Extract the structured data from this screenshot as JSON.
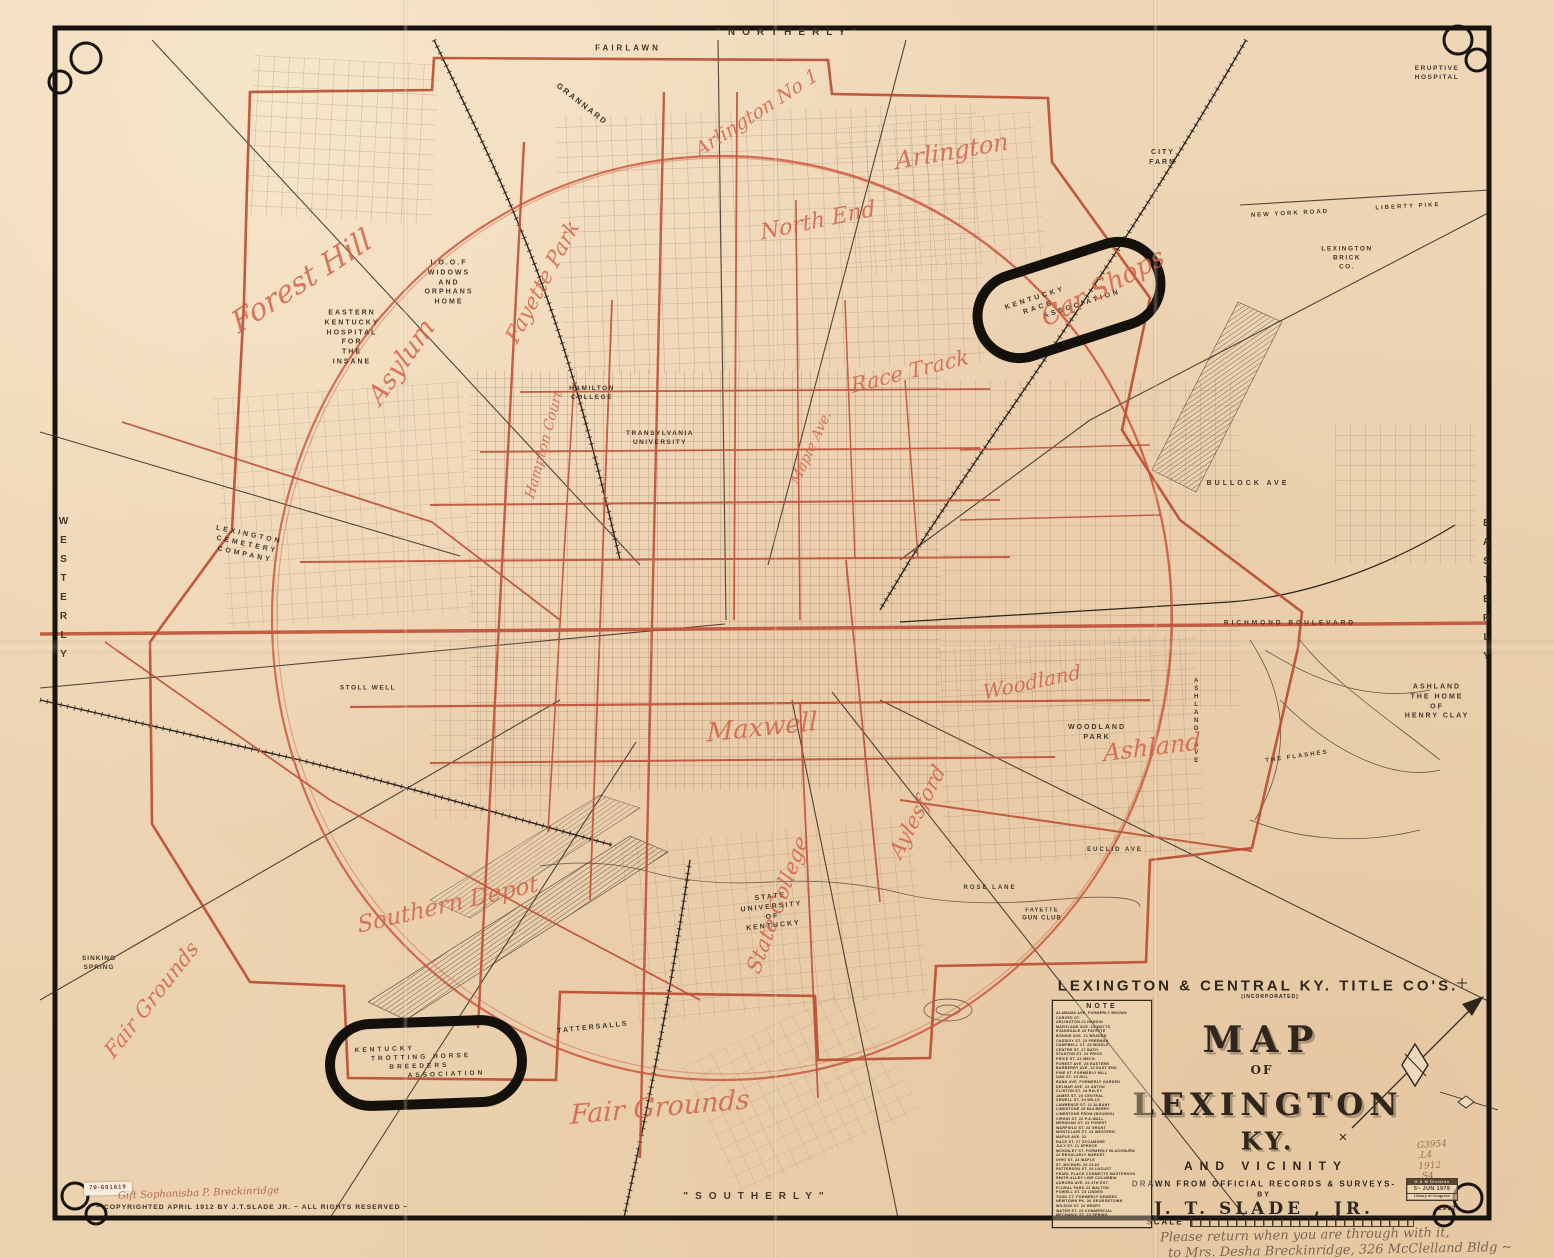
{
  "colors": {
    "paper": "#eed6b6",
    "ink": "#362b20",
    "red_print": "#bf5038",
    "red_script": "#d05f46",
    "frame": "#191310",
    "pencil": "#97714d",
    "graphite": "#6e5d49"
  },
  "map_labels": [
    {
      "n": "northerly",
      "t": "\"NORTHERLY\"",
      "x": 790,
      "y": 33,
      "s": 10,
      "ls": 7,
      "cls": "print"
    },
    {
      "n": "southerly",
      "t": "\"SOUTHERLY\"",
      "x": 757,
      "y": 1197,
      "s": 10,
      "ls": 7,
      "cls": "print"
    },
    {
      "n": "westerly",
      "t": "WESTERLY",
      "x": 63,
      "y": 592,
      "s": 10,
      "ls": 8,
      "cls": "print",
      "vert": true
    },
    {
      "n": "easterly",
      "t": "EASTERLY",
      "x": 1486,
      "y": 594,
      "s": 10,
      "ls": 8,
      "cls": "print",
      "vert": true
    },
    {
      "n": "fairlawn",
      "t": "FAIRLAWN",
      "x": 628,
      "y": 48,
      "s": 8,
      "ls": 3,
      "cls": "print"
    },
    {
      "n": "grannard",
      "t": "GRANNARD",
      "x": 582,
      "y": 104,
      "r": 38,
      "s": 8,
      "ls": 2,
      "cls": "print"
    },
    {
      "n": "city-farm",
      "lines": [
        "CITY",
        "FARM"
      ],
      "x": 1163,
      "y": 158,
      "s": 7,
      "ls": 2,
      "cls": "print"
    },
    {
      "n": "eruptive-hospital",
      "lines": [
        "ERUPTIVE",
        "HOSPITAL"
      ],
      "x": 1437,
      "y": 73,
      "s": 6.5,
      "ls": 1.5,
      "cls": "print"
    },
    {
      "n": "lexington-brick-co",
      "lines": [
        "LEXINGTON",
        "BRICK",
        "CO."
      ],
      "x": 1347,
      "y": 258,
      "s": 6.5,
      "ls": 1.5,
      "cls": "print"
    },
    {
      "n": "new-york-road",
      "t": "NEW YORK ROAD",
      "x": 1290,
      "y": 214,
      "r": -3,
      "s": 6,
      "ls": 2,
      "cls": "print"
    },
    {
      "n": "liberty-pike",
      "t": "LIBERTY PIKE",
      "x": 1408,
      "y": 207,
      "r": -3,
      "s": 6,
      "ls": 2,
      "cls": "print"
    },
    {
      "n": "ioof-home",
      "lines": [
        "I.O.O.F",
        "WIDOWS",
        "AND",
        "ORPHANS",
        "HOME"
      ],
      "x": 449,
      "y": 283,
      "s": 7,
      "ls": 2,
      "cls": "print"
    },
    {
      "n": "eastern-ky-hospital",
      "lines": [
        "EASTERN",
        "KENTUCKY",
        "HOSPITAL",
        "FOR",
        "THE",
        "INSANE"
      ],
      "x": 352,
      "y": 338,
      "s": 7,
      "ls": 2,
      "cls": "print"
    },
    {
      "n": "hamilton-college",
      "lines": [
        "HAMILTON",
        "COLLEGE"
      ],
      "x": 592,
      "y": 393,
      "s": 6.5,
      "ls": 1.5,
      "cls": "print"
    },
    {
      "n": "transylvania-university",
      "lines": [
        "TRANSYLVANIA",
        "UNIVERSITY"
      ],
      "x": 660,
      "y": 438,
      "s": 6.5,
      "ls": 1.5,
      "cls": "print"
    },
    {
      "n": "lexington-cemetery",
      "lines": [
        "LEXINGTON",
        "CEMETERY",
        "COMPANY"
      ],
      "x": 247,
      "y": 545,
      "r": 12,
      "s": 7,
      "ls": 3,
      "cls": "print"
    },
    {
      "n": "stoll-well",
      "t": "STOLL WELL",
      "x": 368,
      "y": 688,
      "s": 6.5,
      "ls": 1.5,
      "cls": "print"
    },
    {
      "n": "sinking-spring",
      "lines": [
        "SINKING",
        "SPRING"
      ],
      "x": 99,
      "y": 963,
      "s": 6.5,
      "ls": 1,
      "cls": "print"
    },
    {
      "n": "tattersalls",
      "t": "TATTERSALLS",
      "x": 593,
      "y": 1028,
      "r": -6,
      "s": 7,
      "ls": 2,
      "cls": "print"
    },
    {
      "n": "state-university",
      "lines": [
        "STATE",
        "UNIVERSITY",
        "OF",
        "KENTUCKY"
      ],
      "x": 772,
      "y": 912,
      "r": -6,
      "s": 7,
      "ls": 2,
      "cls": "print"
    },
    {
      "n": "woodland-park",
      "lines": [
        "WOODLAND",
        "PARK"
      ],
      "x": 1097,
      "y": 733,
      "s": 7,
      "ls": 2,
      "cls": "print"
    },
    {
      "n": "ashland-home",
      "lines": [
        "ASHLAND",
        "THE HOME",
        "OF",
        "HENRY CLAY"
      ],
      "x": 1437,
      "y": 702,
      "s": 7,
      "ls": 2,
      "cls": "print"
    },
    {
      "n": "fayette-gun-club",
      "lines": [
        "FAYETTE",
        "GUN CLUB"
      ],
      "x": 1042,
      "y": 915,
      "s": 6,
      "ls": 1,
      "cls": "print"
    },
    {
      "n": "bullock-ave",
      "t": "BULLOCK AVE",
      "x": 1248,
      "y": 484,
      "s": 7,
      "ls": 3,
      "cls": "print"
    },
    {
      "n": "richmond-boulevard",
      "t": "RICHMOND BOULEVARD",
      "x": 1290,
      "y": 623,
      "s": 6.5,
      "ls": 3,
      "cls": "print"
    },
    {
      "n": "euclid-ave",
      "t": "EUCLID AVE",
      "x": 1115,
      "y": 850,
      "s": 6,
      "ls": 2,
      "cls": "print"
    },
    {
      "n": "rose-lane",
      "t": "ROSE LANE",
      "x": 990,
      "y": 888,
      "s": 6,
      "ls": 2,
      "cls": "print"
    },
    {
      "n": "ashland-ave",
      "t": "ASHLAND AVE",
      "x": 1196,
      "y": 722,
      "s": 6,
      "ls": 2,
      "cls": "print",
      "vert": true
    },
    {
      "n": "the-flashes",
      "t": "THE FLASHES",
      "x": 1297,
      "y": 757,
      "r": -8,
      "s": 6,
      "ls": 2,
      "cls": "print"
    },
    {
      "n": "kentucky-race-association",
      "lines": [
        "KENTUCKY",
        "RACE",
        "ASSOCIATION"
      ],
      "x": 1063,
      "y": 300,
      "r": -18,
      "s": 7,
      "ls": 3,
      "cls": "print",
      "stagger": true
    },
    {
      "n": "ky-trotting-horse",
      "lines": [
        "KENTUCKY",
        "TROTTING HORSE",
        "BREEDERS",
        "ASSOCIATION"
      ],
      "x": 420,
      "y": 1062,
      "r": -2,
      "s": 6.5,
      "ls": 3,
      "cls": "print",
      "stagger": true
    },
    {
      "n": "forest-hill",
      "t": "Forest Hill",
      "x": 302,
      "y": 282,
      "r": -33,
      "s": 30,
      "cls": "script"
    },
    {
      "n": "asylum",
      "t": "Asylum",
      "x": 402,
      "y": 362,
      "r": -55,
      "s": 26,
      "cls": "script"
    },
    {
      "n": "fayette-park",
      "t": "Fayette Park",
      "x": 543,
      "y": 282,
      "r": -62,
      "s": 21,
      "cls": "script"
    },
    {
      "n": "arlington-no-1",
      "t": "Arlington No 1",
      "x": 757,
      "y": 113,
      "r": -33,
      "s": 19,
      "cls": "script"
    },
    {
      "n": "arlington",
      "t": "Arlington",
      "x": 952,
      "y": 152,
      "r": -10,
      "s": 24,
      "cls": "script"
    },
    {
      "n": "north-end",
      "t": "North End",
      "x": 818,
      "y": 222,
      "r": -12,
      "s": 22,
      "cls": "script"
    },
    {
      "n": "car-shops",
      "t": "Car Shops",
      "x": 1103,
      "y": 288,
      "r": -28,
      "s": 26,
      "cls": "script"
    },
    {
      "n": "race-track",
      "t": "Race Track",
      "x": 910,
      "y": 372,
      "r": -14,
      "s": 21,
      "cls": "script"
    },
    {
      "n": "maple-ave",
      "t": "Maple Ave.",
      "x": 812,
      "y": 448,
      "r": -65,
      "s": 14,
      "cls": "script"
    },
    {
      "n": "hampton-court",
      "t": "Hampton Court",
      "x": 545,
      "y": 445,
      "r": -75,
      "s": 14,
      "cls": "script"
    },
    {
      "n": "maxwell",
      "t": "Maxwell",
      "x": 762,
      "y": 728,
      "r": -6,
      "s": 26,
      "cls": "script"
    },
    {
      "n": "woodland",
      "t": "Woodland",
      "x": 1032,
      "y": 682,
      "r": -12,
      "s": 20,
      "cls": "script"
    },
    {
      "n": "ashland-script",
      "t": "Ashland",
      "x": 1152,
      "y": 748,
      "r": -7,
      "s": 24,
      "cls": "script"
    },
    {
      "n": "aylesford",
      "t": "Aylesford",
      "x": 918,
      "y": 812,
      "r": -63,
      "s": 21,
      "cls": "script"
    },
    {
      "n": "state-college",
      "t": "State College",
      "x": 778,
      "y": 905,
      "r": -70,
      "s": 21,
      "cls": "script"
    },
    {
      "n": "southern-depot",
      "t": "Southern Depot",
      "x": 448,
      "y": 905,
      "r": -13,
      "s": 23,
      "cls": "script"
    },
    {
      "n": "fair-grounds-west",
      "t": "Fair Grounds",
      "x": 152,
      "y": 1000,
      "r": -52,
      "s": 21,
      "cls": "script"
    },
    {
      "n": "fair-grounds-south",
      "t": "Fair Grounds",
      "x": 660,
      "y": 1108,
      "r": -5,
      "s": 27,
      "cls": "script"
    }
  ],
  "title_block": {
    "company": "LEXINGTON & CENTRAL KY. TITLE CO'S.",
    "incorporated": "(INCORPORATED)",
    "map_word": "MAP",
    "of_word": "OF",
    "city": "LEXINGTON",
    "state": "KY.",
    "vicinity": "AND VICINITY",
    "drawn": "DRAWN FROM OFFICIAL RECORDS & SURVEYS-",
    "by": "BY",
    "author": "J. T. SLADE , JR.",
    "scale_label": "SCALE"
  },
  "note_box": {
    "title": "NOTE",
    "rows": [
      "ALABAMA AVE. FORMERLY BROWN",
      "CURVED ST.",
      "ARLINGTON 22 HARDIN",
      "MARYLAND AVE. 24 WATTS",
      "EVANSDALE 26 FAYETTE",
      "BONNIE AVE. 21 BRADEN",
      "CASSIDY ST. 23 FREEMAN",
      "CAMPBELL CT. 25 MIDDLE",
      "CENTRE ST. 27 BATH",
      "STANTON ST. 24 PRICE",
      "PRICE ST. 22 MECH.",
      "FOREST AVE. 28 EASTERN",
      "BARBERRY AVE. 23 EAST END",
      "PINE ST. FORMERLY MILL",
      "OAK ST. 24 HILL",
      "RAND AVE. FORMERLY GARDEN",
      "DELMAR AVE. 22 ANTON",
      "CLINTON ST. 24 RALEY",
      "JAMES ST. 23 CENTRAL",
      "SEWELL ST. 24 WILLS",
      "LAWRENCE ST. 22 ALBANY",
      "LIMESTONE 26 MULBERRY",
      "LIMESTONE FROM (BOUNDS)",
      "VIRGIN ST. 22 P.A.WALL",
      "MERIDIAN ST. 24 FOREST",
      "WARFIELD ST. 23 GRANT",
      "MONTCLAIR ST. 24 WESTERN",
      "MAPLE AVE. 22",
      "RACE ST. 27 SYCAMORE",
      "JULY ST. 21 SPENCE",
      "MCKINLEY ST. FORMERLY BLACKBURN",
      "22 REGULARLY MARKET",
      "OHIO ST. 24 MAPLE",
      "ST. MICHAEL 26 CLAY",
      "PATTERSON ST. 23 LOCUST",
      "PEARL PLACE CONNECTS MASTERSON",
      "SMITH ALLEY LINE COLUMBIA",
      "AURORA AVE. 24 4TH EXT.",
      "FLORAL PARK 22 WALTON",
      "POWELL ST. 23 LINDEN",
      "TODD CT. FORMERLY DEWEES",
      "NEWTOWN PK. 26 GEORGETOWN",
      "WILSON ST. 22 HENRY",
      "WATER ST. 24 COMMERCIAL",
      "MECHANIC ST. 23 SPRING"
    ]
  },
  "stamps": {
    "sticker": "79-691619",
    "gift": "Gift Sophonisba P. Breckinridge",
    "copyright": "~ COPYRIGHTED APRIL 1912 BY J.T.SLADE JR. ~ ALL RIGHTS RESERVED ~",
    "catalog": [
      "G3954",
      ".L4",
      "1912",
      ".S4"
    ],
    "lc_stamp": [
      "G & M Division",
      "5~ JUN 1979",
      "Library of Congress"
    ],
    "corner_year": "1912",
    "return_note": [
      "Please return when you are through with it,",
      "to Mrs. Desha Breckinridge, 326 McClelland Bldg ~"
    ]
  }
}
